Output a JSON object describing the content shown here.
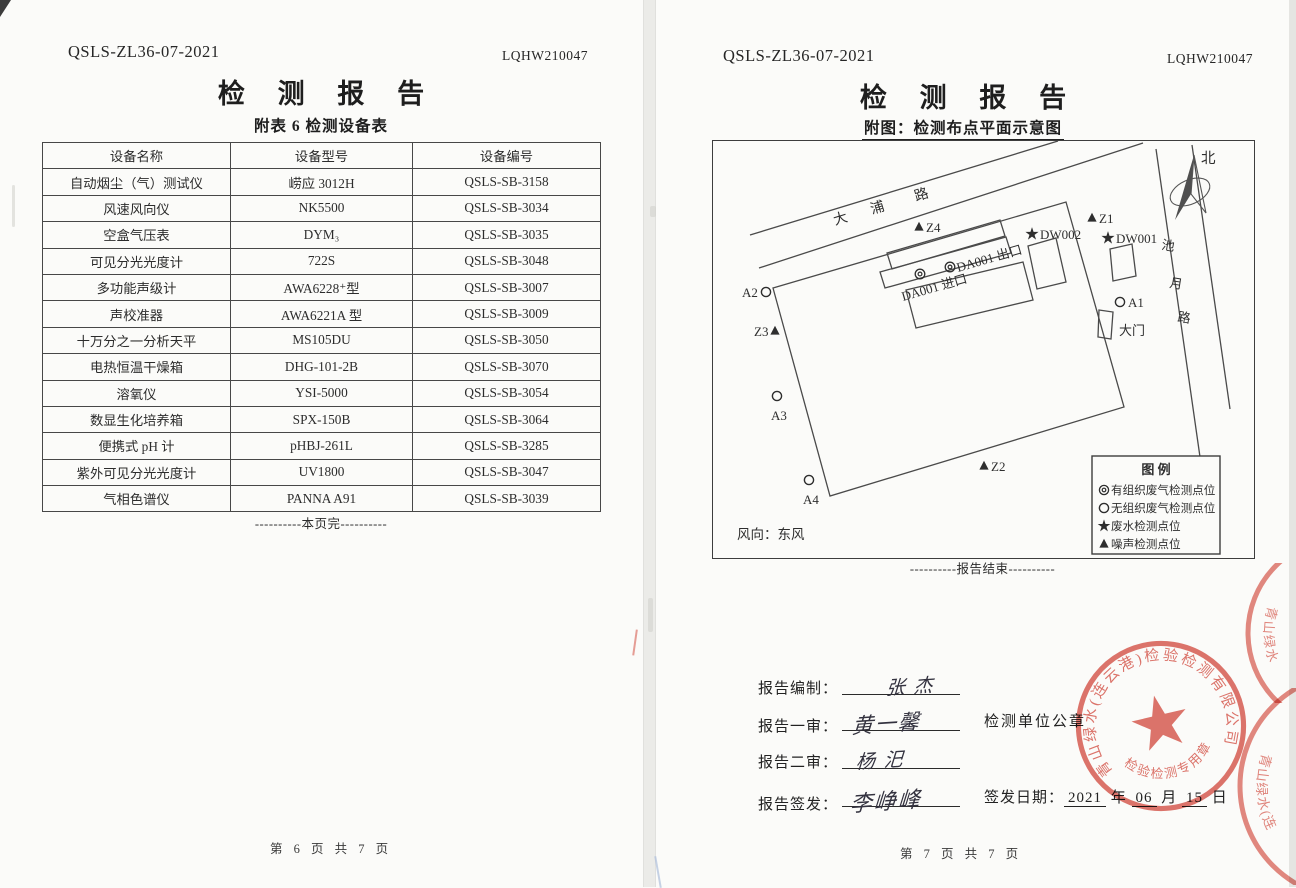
{
  "pages": {
    "left": {
      "doc_code": "QSLS-ZL36-07-2021",
      "report_no": "LQHW210047",
      "title": "检 测 报 告",
      "subtitle": "附表 6  检测设备表",
      "table": {
        "headers": [
          "设备名称",
          "设备型号",
          "设备编号"
        ],
        "rows": [
          [
            "自动烟尘（气）测试仪",
            "崂应 3012H",
            "QSLS-SB-3158"
          ],
          [
            "风速风向仪",
            "NK5500",
            "QSLS-SB-3034"
          ],
          [
            "空盒气压表",
            "DYM₃",
            "QSLS-SB-3035"
          ],
          [
            "可见分光光度计",
            "722S",
            "QSLS-SB-3048"
          ],
          [
            "多功能声级计",
            "AWA6228⁺型",
            "QSLS-SB-3007"
          ],
          [
            "声校准器",
            "AWA6221A 型",
            "QSLS-SB-3009"
          ],
          [
            "十万分之一分析天平",
            "MS105DU",
            "QSLS-SB-3050"
          ],
          [
            "电热恒温干燥箱",
            "DHG-101-2B",
            "QSLS-SB-3070"
          ],
          [
            "溶氧仪",
            "YSI-5000",
            "QSLS-SB-3054"
          ],
          [
            "数显生化培养箱",
            "SPX-150B",
            "QSLS-SB-3064"
          ],
          [
            "便携式 pH 计",
            "pHBJ-261L",
            "QSLS-SB-3285"
          ],
          [
            "紫外可见分光光度计",
            "UV1800",
            "QSLS-SB-3047"
          ],
          [
            "气相色谱仪",
            "PANNA A91",
            "QSLS-SB-3039"
          ]
        ]
      },
      "end_note": "----------本页完----------",
      "page_footer": "第 6 页 共 7 页"
    },
    "right": {
      "doc_code": "QSLS-ZL36-07-2021",
      "report_no": "LQHW210047",
      "title": "检 测 报 告",
      "subtitle": "附图：检测布点平面示意图",
      "diagram": {
        "north": "北",
        "road_top": {
          "c1": "大",
          "c2": "浦",
          "c3": "路"
        },
        "road_right": {
          "c1": "池",
          "c2": "月",
          "c3": "路"
        },
        "points": {
          "z4": "Z4",
          "z1": "Z1",
          "z2": "Z2",
          "z3": "Z3",
          "dw002": "DW002",
          "dw001": "DW001",
          "a1": "A1",
          "a2": "A2",
          "a3": "A3",
          "a4": "A4"
        },
        "da001_out": "DA001 出口",
        "da001_in": "DA001 进口",
        "gate": "大门",
        "wind": "风向：东风",
        "legend": {
          "title": "图  例",
          "item1": "有组织废气检测点位",
          "item2": "无组织废气检测点位",
          "item3": "废水检测点位",
          "item4": "噪声检测点位"
        }
      },
      "end_note": "----------报告结束----------",
      "signatures": [
        {
          "label": "报告编制：",
          "name": "张 杰"
        },
        {
          "label": "报告一审：",
          "name": "黄一馨"
        },
        {
          "label": "报告二审：",
          "name": "杨 汜"
        },
        {
          "label": "报告签发：",
          "name": "李峥峰"
        }
      ],
      "stamp_note": "检测单位公章",
      "issue_date": {
        "label": "签发日期：",
        "year": "2021",
        "y_unit": "年",
        "month": "06",
        "m_unit": "月",
        "day": "15",
        "d_unit": "日"
      },
      "seal": {
        "company": "青山绿水(连云港)检验检测有限公司",
        "type": "检验检测专用章",
        "color": "#d8564b"
      },
      "page_footer": "第 7 页 共 7 页"
    }
  }
}
